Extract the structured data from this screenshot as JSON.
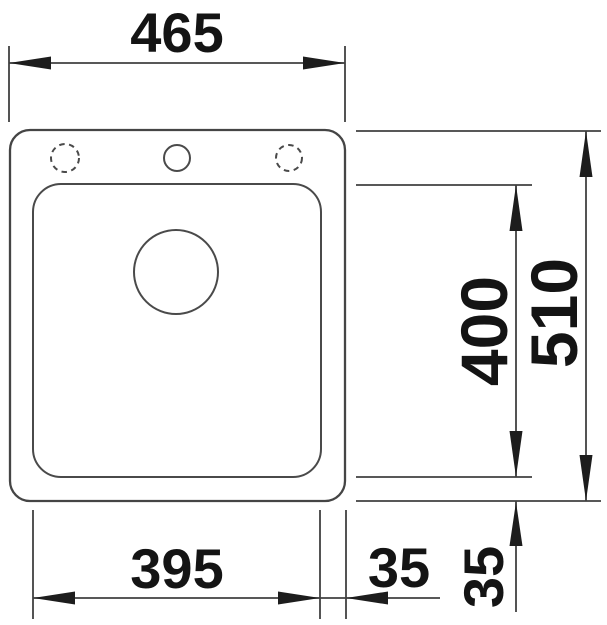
{
  "drawing": {
    "subject": "sink-top-view-technical-drawing",
    "background_color": "#ffffff",
    "line_color": "#454545",
    "text_color": "#141414",
    "dimensions": {
      "overall_width": "465",
      "overall_depth": "510",
      "bowl_length": "400",
      "bowl_width": "395",
      "bowl_side_offset": "35",
      "bowl_bottom_offset": "35"
    }
  }
}
